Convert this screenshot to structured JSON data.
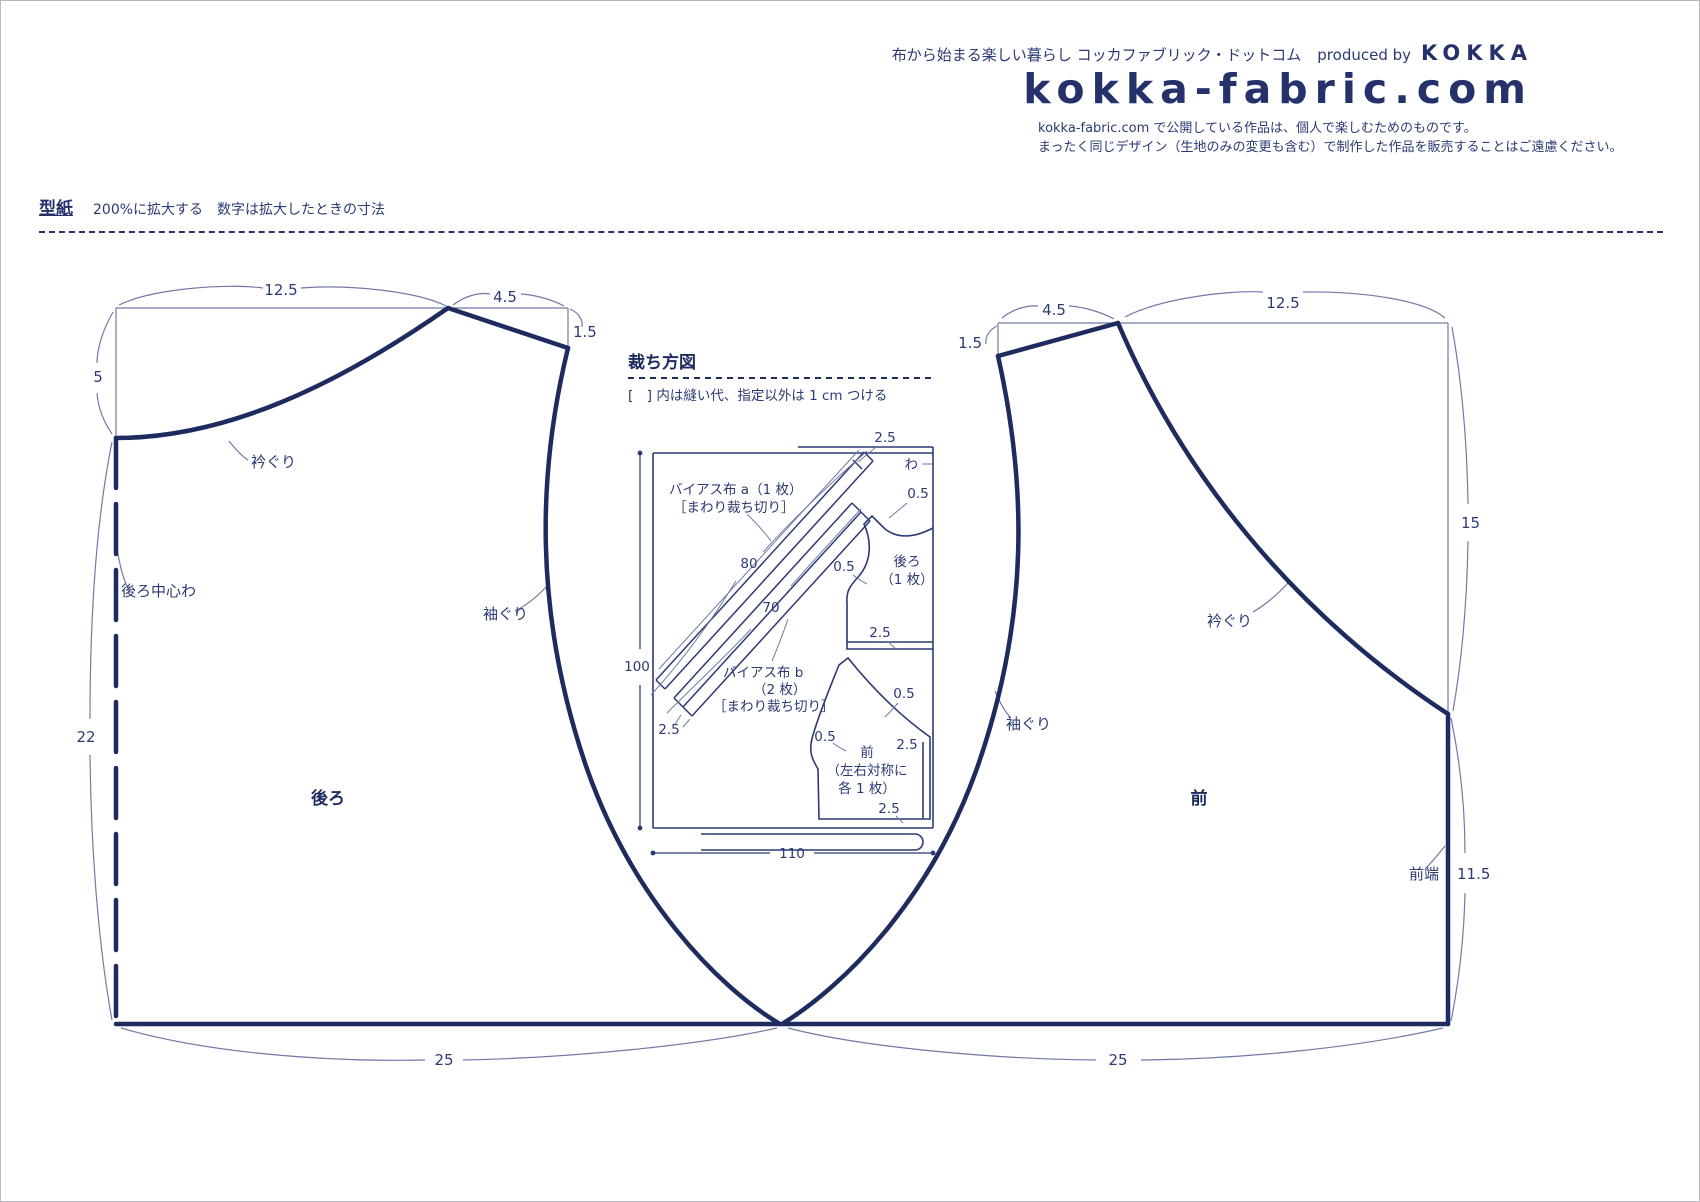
{
  "colors": {
    "navy": "#1e2b5f",
    "thin_line": "#717aa6",
    "text": "#2b3a74"
  },
  "header": {
    "tagline_jp": "布から始まる楽しい暮らし コッカファブリック・ドットコム",
    "produced_by": "produced by",
    "brand": "KOKKA",
    "logo": "kokka-fabric.com",
    "notice_line1": "kokka-fabric.com で公開している作品は、個人で楽しむためのものです。",
    "notice_line2": "まったく同じデザイン（生地のみの変更も含む）で制作した作品を販売することはご遠慮ください。"
  },
  "pattern_header": {
    "title": "型紙",
    "subtitle": "200%に拡大する　数字は拡大したときの寸法"
  },
  "back_piece": {
    "name": "後ろ",
    "labels": {
      "neckline": "衿ぐり",
      "center_fold": "後ろ中心わ",
      "armhole": "袖ぐり"
    },
    "dims": {
      "top_width": "12.5",
      "shoulder": "4.5",
      "shoulder_drop": "1.5",
      "neck_depth": "5",
      "side_length": "22",
      "bottom_width": "25"
    }
  },
  "front_piece": {
    "name": "前",
    "labels": {
      "neckline": "衿ぐり",
      "armhole": "袖ぐり",
      "front_edge": "前端"
    },
    "dims": {
      "top_width": "12.5",
      "shoulder": "4.5",
      "shoulder_drop": "1.5",
      "side_length": "15",
      "front_edge_length": "11.5",
      "bottom_width": "25"
    }
  },
  "cutting_layout": {
    "title": "裁ち方図",
    "note": "[　] 内は縫い代、指定以外は 1 cm つける",
    "fabric_width": "110",
    "fabric_length": "100",
    "fold": "わ",
    "bias_a": {
      "line1": "バイアス布 a（1 枚）",
      "line2": "［まわり裁ち切り］",
      "length": "80",
      "end_allowance": "2.5"
    },
    "bias_b": {
      "line1": "バイアス布 b",
      "line2": "（2 枚）",
      "line3": "［まわり裁ち切り］",
      "length": "70",
      "end_allowance": "2.5"
    },
    "back_cut": {
      "name": "後ろ",
      "count": "（1 枚）",
      "neck": "0.5",
      "armhole": "0.5",
      "hem": "2.5"
    },
    "front_cut": {
      "name": "前",
      "count_l1": "（左右対称に",
      "count_l2": "各 1 枚）",
      "neck": "0.5",
      "armhole": "0.5",
      "side": "2.5",
      "hem": "2.5"
    }
  }
}
